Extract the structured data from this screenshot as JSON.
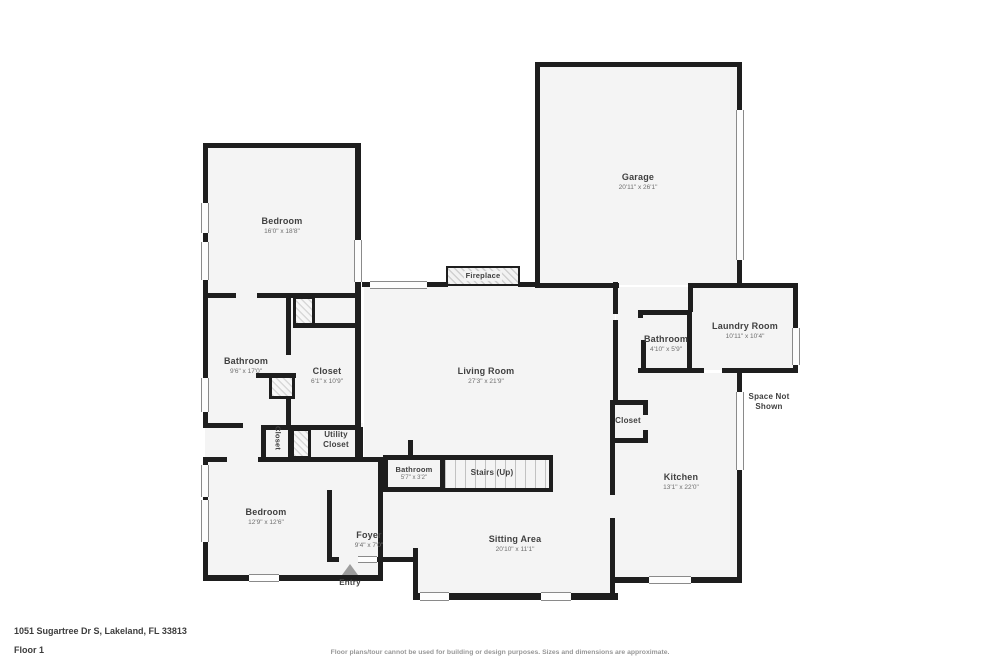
{
  "colors": {
    "wall": "#1e1e1e",
    "floor": "#f4f4f4",
    "window_line": "#8a8a8a",
    "room_name_text": "#404040",
    "room_dims_text": "#6e6e6e",
    "entry_arrow": "#9d9d9d",
    "muted_text": "#979797"
  },
  "rooms": {
    "garage": {
      "name": "Garage",
      "dims": "20'11\" x 26'1\""
    },
    "bedroom_top": {
      "name": "Bedroom",
      "dims": "16'0\" x 18'8\""
    },
    "bathroom_left": {
      "name": "Bathroom",
      "dims": "9'6\" x 17'0\""
    },
    "closet_main": {
      "name": "Closet",
      "dims": "6'1\" x 10'9\""
    },
    "closet_small": {
      "name": "Closet"
    },
    "utility_closet": {
      "name": "Utility Closet"
    },
    "bedroom_bottom": {
      "name": "Bedroom",
      "dims": "12'9\" x 12'6\""
    },
    "living_room": {
      "name": "Living Room",
      "dims": "27'3\" x 21'9\""
    },
    "fireplace": {
      "name": "Fireplace"
    },
    "bathroom_right": {
      "name": "Bathroom",
      "dims": "4'10\" x 5'9\""
    },
    "laundry_room": {
      "name": "Laundry Room",
      "dims": "10'11\" x 10'4\""
    },
    "space_not_shown": {
      "name": "Space Not Shown"
    },
    "closet_kitchen": {
      "name": "Closet"
    },
    "kitchen": {
      "name": "Kitchen",
      "dims": "13'1\" x 22'0\""
    },
    "bathroom_center": {
      "name": "Bathroom",
      "dims": "5'7\" x 3'2\""
    },
    "stairs": {
      "name": "Stairs (Up)"
    },
    "foyer": {
      "name": "Foyer",
      "dims": "9'4\" x 7'0\""
    },
    "sitting_area": {
      "name": "Sitting Area",
      "dims": "20'10\" x 11'1\""
    },
    "entry": {
      "name": "Entry"
    }
  },
  "footer": {
    "address": "1051 Sugartree Dr S, Lakeland, FL 33813",
    "floor_label": "Floor 1",
    "disclaimer": "Floor plans/tour cannot be used for building or design purposes. Sizes and dimensions are approximate."
  }
}
